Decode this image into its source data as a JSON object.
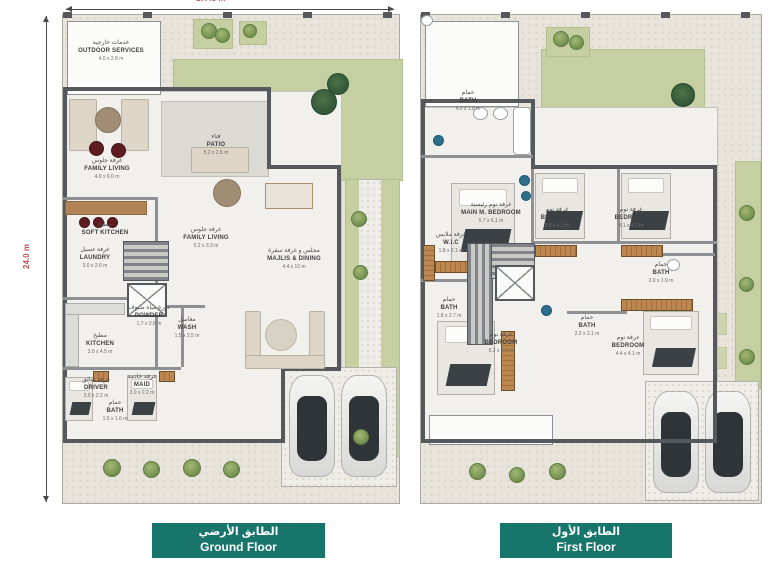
{
  "meta": {
    "top_dim": "17.45 m",
    "left_dim": "24.0 m"
  },
  "ground": {
    "button": {
      "ar": "الطابق الأرضي",
      "en": "Ground Floor"
    },
    "rooms": [
      {
        "ar": "خدمات خارجية",
        "en": "OUTDOOR SERVICES",
        "dim": "4.0 x 2.8 m"
      },
      {
        "ar": "غرفة جلوس",
        "en": "FAMILY LIVING",
        "dim": "4.0 x 6.0 m"
      },
      {
        "ar": "فناء",
        "en": "PATIO",
        "dim": "5.2 x 2.5 m"
      },
      {
        "ar": "مطبخ",
        "en": "SOFT KITCHEN",
        "dim": ""
      },
      {
        "ar": "غرفة جلوس",
        "en": "FAMILY LIVING",
        "dim": "5.2 x 3.3 m"
      },
      {
        "ar": "غرفة غسيل",
        "en": "LAUNDRY",
        "dim": "3.0 x 2.0 m"
      },
      {
        "ar": "مجلس و غرفة سفرة",
        "en": "MAJLIS & DINING",
        "dim": "4.4 x 10 m"
      },
      {
        "ar": "مطبخ",
        "en": "KITCHEN",
        "dim": "3.0 x 4.5 m"
      },
      {
        "ar": "دورة مياه ضيوف",
        "en": "POWDER",
        "dim": "1.7 x 2.6 m"
      },
      {
        "ar": "مغاسل",
        "en": "WASH",
        "dim": "1.5 x 2.5 m"
      },
      {
        "ar": "غرفة سائق",
        "en": "DRIVER",
        "dim": "3.0 x 2.2 m"
      },
      {
        "ar": "حمام",
        "en": "BATH",
        "dim": "1.5 x 1.6 m"
      },
      {
        "ar": "غرفة خادمة",
        "en": "MAID",
        "dim": "3.0 x 2.2 m"
      }
    ]
  },
  "first": {
    "button": {
      "ar": "الطابق الأول",
      "en": "First Floor"
    },
    "rooms": [
      {
        "ar": "حمام",
        "en": "BATH",
        "dim": "4.0 x 1.8 m"
      },
      {
        "ar": "غرفة نوم رئيسية",
        "en": "MAIN M. BEDROOM",
        "dim": "5.7 x 6.1 m"
      },
      {
        "ar": "غرفة ملابس",
        "en": "W.I.C",
        "dim": "1.8 x 2.1 m"
      },
      {
        "ar": "غرفة نوم",
        "en": "BEDROOM",
        "dim": "3.6 x 4.2 m"
      },
      {
        "ar": "غرفة نوم",
        "en": "BEDROOM",
        "dim": "4.1 x 4.2 m"
      },
      {
        "ar": "حمام",
        "en": "BATH",
        "dim": "1.8 x 2.7 m"
      },
      {
        "ar": "حمام",
        "en": "BATH",
        "dim": "2.9 x 1.9 m"
      },
      {
        "ar": "غرفة نوم",
        "en": "BEDROOM",
        "dim": "5.2 x 4.0 m"
      },
      {
        "ar": "حمام",
        "en": "BATH",
        "dim": "2.2 x 2.1 m"
      },
      {
        "ar": "غرفة نوم",
        "en": "BEDROOM",
        "dim": "4.4 x 4.1 m"
      }
    ]
  }
}
